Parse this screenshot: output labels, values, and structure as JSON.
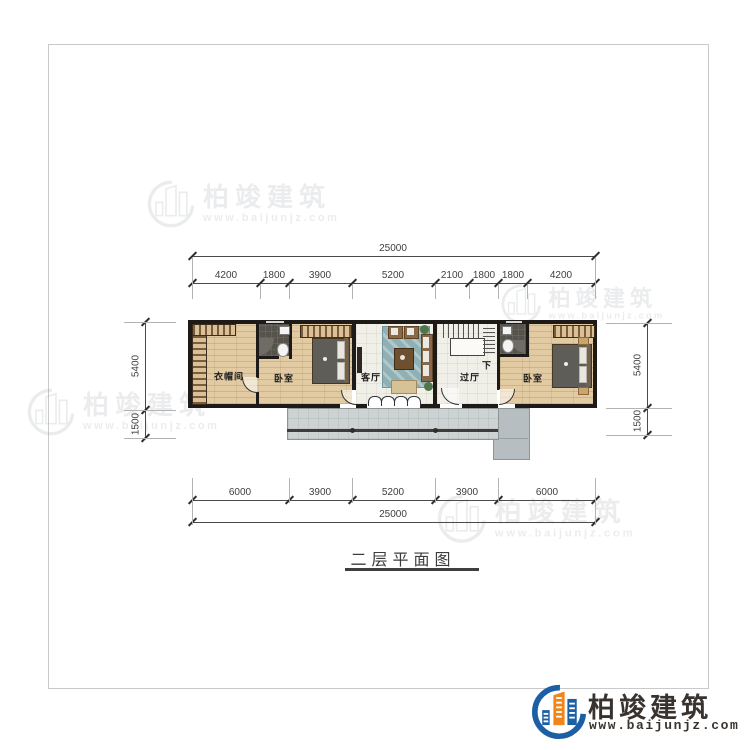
{
  "title": {
    "text": "二层平面图"
  },
  "brand": {
    "name": "柏竣建筑",
    "url": "www.baijunjz.com"
  },
  "rooms": {
    "cloakroom": "衣帽间",
    "bedroom_left": "卧室",
    "living": "客厅",
    "hall": "过厅",
    "bedroom_right": "卧室",
    "stairs_down": "下"
  },
  "dims": {
    "top_total": "25000",
    "top_segments": [
      "4200",
      "1800",
      "3900",
      "5200",
      "2100",
      "1800",
      "1800",
      "4200"
    ],
    "bottom_segments": [
      "6000",
      "3900",
      "5200",
      "3900",
      "6000"
    ],
    "bottom_total": "25000",
    "left_segments": [
      "5400",
      "1500"
    ],
    "right_segments": [
      "5400",
      "1500"
    ]
  },
  "colors": {
    "wall": "#1d1a17",
    "wood": "#e2cba2",
    "accent_blue": "#1d5fa5",
    "accent_orange": "#f08519"
  }
}
